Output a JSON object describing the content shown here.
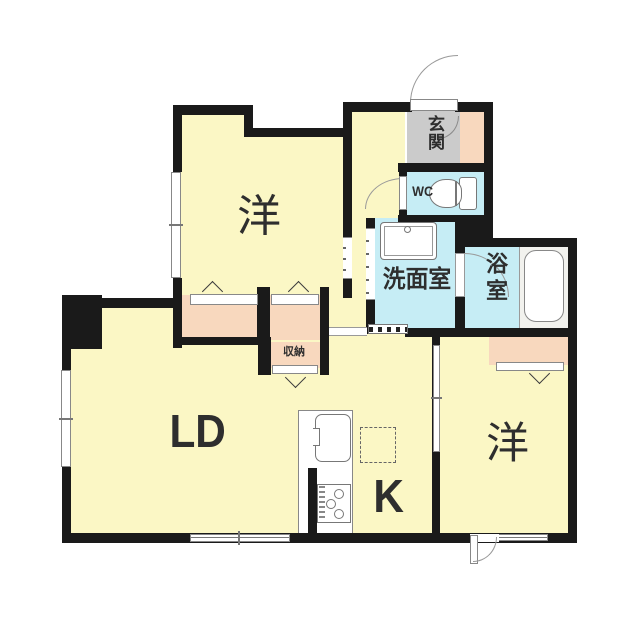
{
  "title": "1LDK apartment floor plan",
  "rooms": {
    "bedroom_top": {
      "label": "洋"
    },
    "bedroom_right": {
      "label": "洋"
    },
    "living_dining": {
      "label": "LD"
    },
    "kitchen": {
      "label": "K"
    },
    "entrance": {
      "label": "玄関"
    },
    "toilet": {
      "label": "WC"
    },
    "washroom": {
      "label": "洗面室"
    },
    "bathroom": {
      "label": "浴室"
    },
    "storage": {
      "label": "収納"
    }
  },
  "colors": {
    "wall": "#1a1a1a",
    "room_floor": "#fbf7c5",
    "wet_area": "#c6edf5",
    "closet": "#f8d8be",
    "entrance_tile": "#cbcbcb",
    "bath_deck": "#f2f2ee",
    "fixture_line": "#777777",
    "label_text": "#2e2e2e"
  }
}
